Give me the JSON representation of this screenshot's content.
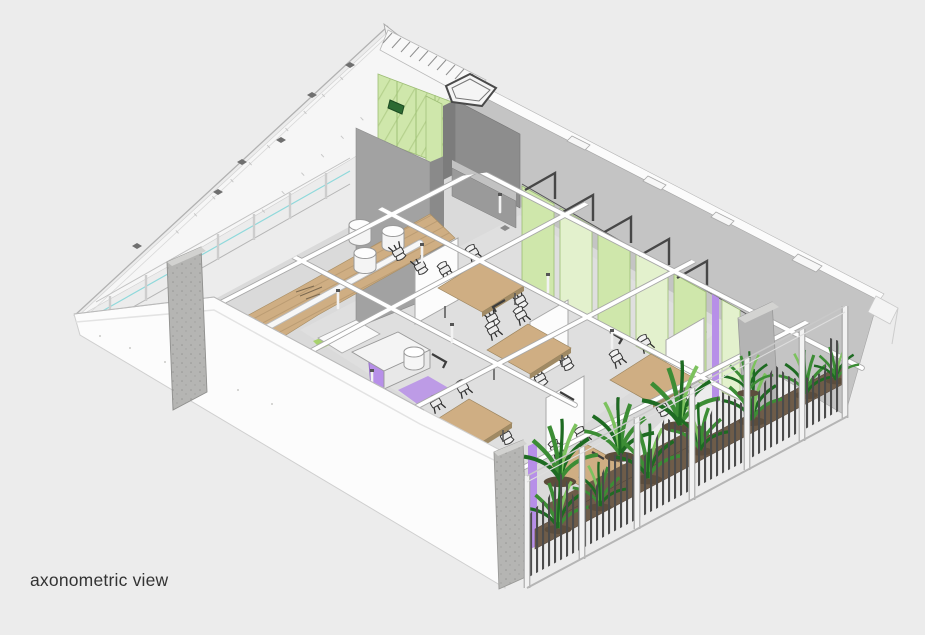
{
  "caption": {
    "label": "axonometric view"
  },
  "palette": {
    "background": "#ececec",
    "white_surface": "#fbfbfb",
    "roof_gray": "#c4c4c4",
    "wall_dark_gray": "#9b9b9b",
    "concrete": "#b5b5b3",
    "floor_gray": "#dadada",
    "wood": "#cfae83",
    "wood_dark": "#a08a64",
    "green_glass": "#cfe7ab",
    "green_glass_light": "#e3f1cd",
    "plant_green": "#3c8d35",
    "plant_green_dark": "#1e6b22",
    "plant_green_light": "#7cc25e",
    "purple_accent": "#b78fe8",
    "planter_brown": "#6e5c49",
    "frame_dark": "#4a4a4a",
    "teal_accent": "#86d7da",
    "text": "#333333"
  },
  "scene": {
    "type": "architectural-axonometric-render",
    "elements": [
      "roof-plane",
      "roof-edge-spike",
      "left-glazing-wall",
      "back-wall",
      "green-glass-upper-wall",
      "skylight-frame",
      "right-exterior-wall",
      "green-partition-row",
      "purple-accent-panels",
      "interior-floor",
      "wood-platform",
      "cylinder-stools",
      "kitchen-counter",
      "meeting-tables",
      "chairs",
      "privacy-screens",
      "ceiling-service-pipes",
      "front-left-wall",
      "concrete-columns",
      "planter-fence",
      "plants",
      "utility-box"
    ]
  }
}
